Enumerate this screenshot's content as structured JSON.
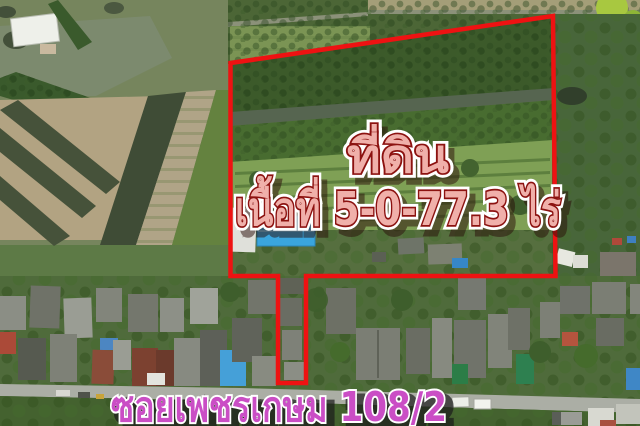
{
  "overlays": {
    "land_title": "ที่ดิน",
    "land_area": "เนื้อที่ 5-0-77.3 ไร่",
    "road_name": "ซอยเพชรเกษม 108/2",
    "colors": {
      "boundary": "#ee1212",
      "area_text_fill": "#f0b0aa",
      "area_text_outline": "#8c1210",
      "road_text_fill": "#ca4ec5",
      "road_text_outline": "#ffffff"
    }
  }
}
